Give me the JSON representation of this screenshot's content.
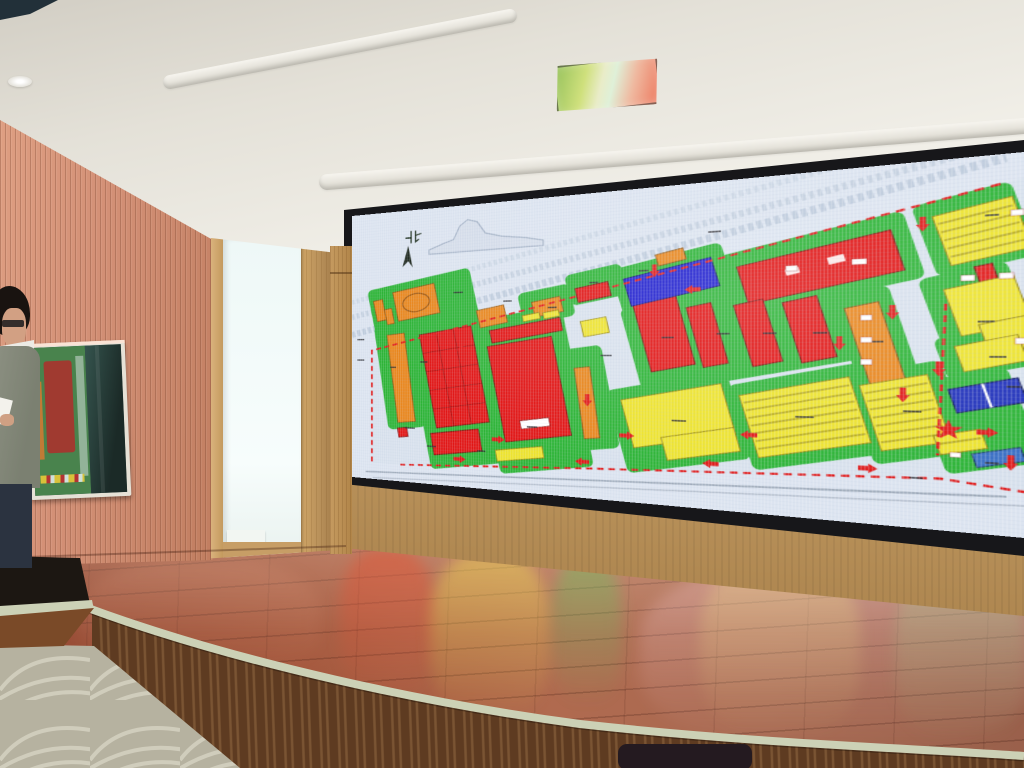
{
  "scene": {
    "setting": "presentation room with curved wooden stage and wall-size LED video wall",
    "colors": {
      "wall": "#d39076",
      "stage_floor": "#a3553a",
      "stage_trim": "#ccd1b6",
      "stage_fascia": "#5e3b21",
      "carpet": "#b6b2a0",
      "screen_bezel": "#17171a"
    }
  },
  "map": {
    "bg": "#dce4f0",
    "palette": {
      "green": "#2db437",
      "o": {
        "f": "#e8861d",
        "s": "#8a5210"
      },
      "r": {
        "f": "#e11616",
        "s": "#7d0b0b"
      },
      "y": {
        "f": "#ede32e",
        "s": "#94850e"
      },
      "b": {
        "f": "#2020cf",
        "s": "#10106a"
      },
      "b2": {
        "f": "#2233bb",
        "s": "#101a5a"
      },
      "b3": {
        "f": "#3a6fc4",
        "s": "#1c3a6a"
      }
    },
    "outside": {
      "lines": [
        {
          "d": "M0,150 L656,-10",
          "w": 8,
          "s": "#bfccdc",
          "dash": "4 3",
          "o": 0.8
        },
        {
          "d": "M0,128 L640,-30",
          "w": 7,
          "s": "#c5d1e0",
          "dash": "4 3",
          "o": 0.7
        },
        {
          "d": "M0,176 L660,4",
          "w": 9,
          "s": "#b8c6d8",
          "dash": "5 3",
          "o": 0.8
        },
        {
          "d": "M20,376 L660,346",
          "w": 2,
          "s": "#97a3b2",
          "o": 0.9
        },
        {
          "d": "M30,384 L672,354",
          "w": 1.5,
          "s": "#a8b2c0",
          "o": 0.8
        }
      ],
      "skyline": "M108,58 L128,50 L140,46 L148,28 L158,20 L170,24 L180,40 L200,46 L228,50 L249,55 L249,62 L108,64 Z"
    },
    "site": {
      "points": "29,199 656,30 672,26 672,342 613,332 69,362 29,362",
      "fill": "#d8e1ed"
    },
    "green": [
      [
        28,
        98,
        140,
        74,
        -11
      ],
      [
        42,
        160,
        52,
        150,
        -8
      ],
      [
        92,
        148,
        100,
        210,
        -10
      ],
      [
        180,
        148,
        108,
        208,
        -10
      ],
      [
        222,
        118,
        60,
        42,
        -11
      ],
      [
        276,
        96,
        62,
        40,
        -12
      ],
      [
        278,
        194,
        45,
        130,
        -9
      ],
      [
        328,
        84,
        112,
        58,
        -14
      ],
      [
        436,
        68,
        160,
        74,
        -14
      ],
      [
        342,
        124,
        200,
        108,
        -13
      ],
      [
        540,
        132,
        48,
        114,
        -14
      ],
      [
        328,
        234,
        122,
        104,
        -13
      ],
      [
        448,
        224,
        118,
        100,
        -14
      ],
      [
        550,
        216,
        76,
        98,
        -14
      ],
      [
        600,
        36,
        74,
        78,
        -15
      ],
      [
        608,
        114,
        66,
        102,
        -15
      ],
      [
        612,
        178,
        62,
        44,
        -15
      ],
      [
        604,
        222,
        70,
        98,
        -15
      ]
    ],
    "buildings": [
      [
        "o",
        62,
        110,
        57,
        42,
        -11,
        "ellipse"
      ],
      [
        "o",
        34,
        126,
        13,
        30,
        -11
      ],
      [
        "o",
        49,
        139,
        10,
        22,
        -11
      ],
      [
        "o",
        171,
        141,
        34,
        24,
        -12
      ],
      [
        "o",
        237,
        132,
        33,
        20,
        -12
      ],
      [
        "o",
        58,
        175,
        24,
        126,
        -7
      ],
      [
        "o",
        289,
        220,
        17,
        90,
        -7
      ],
      [
        "o",
        549,
        148,
        28,
        86,
        -14
      ],
      [
        "o",
        370,
        79,
        28,
        14,
        -14
      ],
      [
        "r",
        106,
        170,
        68,
        132,
        -10,
        "grid"
      ],
      [
        "r",
        112,
        310,
        62,
        30,
        -9
      ],
      [
        "r",
        186,
        164,
        84,
        17,
        -11
      ],
      [
        "r",
        193,
        186,
        77,
        129,
        -10,
        "label"
      ],
      [
        "r",
        286,
        116,
        36,
        18,
        -12
      ],
      [
        "r",
        450,
        85,
        133,
        45,
        -14,
        "windows"
      ],
      [
        "r",
        355,
        137,
        44,
        84,
        -13
      ],
      [
        "r",
        407,
        144,
        24,
        73,
        -13
      ],
      [
        "r",
        452,
        142,
        27,
        73,
        -14
      ],
      [
        "r",
        495,
        140,
        30,
        70,
        -14
      ],
      [
        "r",
        66,
        309,
        13,
        13,
        -8
      ],
      [
        "r",
        640,
        111,
        13,
        22,
        -14
      ],
      [
        "y",
        193,
        328,
        56,
        15,
        -9
      ],
      [
        "y",
        225,
        151,
        20,
        8,
        -11
      ],
      [
        "y",
        249,
        148,
        18,
        8,
        -11
      ],
      [
        "y",
        292,
        159,
        28,
        20,
        -11
      ],
      [
        "y",
        339,
        248,
        101,
        60,
        -13,
        "notch"
      ],
      [
        "y",
        456,
        238,
        97,
        73,
        -14,
        "stripes"
      ],
      [
        "y",
        559,
        229,
        54,
        72,
        -14,
        "stripes"
      ],
      [
        "y",
        613,
        50,
        59,
        54,
        -15,
        "stripes"
      ],
      [
        "y",
        621,
        128,
        51,
        50,
        -15,
        "step"
      ],
      [
        "y",
        626,
        188,
        46,
        27,
        -15
      ],
      [
        "y",
        610,
        283,
        35,
        20,
        -15,
        "stripes"
      ],
      [
        "b",
        339,
        99,
        89,
        35,
        -14
      ],
      [
        "b2",
        621,
        232,
        51,
        25,
        -15,
        "split"
      ],
      [
        "b3",
        637,
        300,
        35,
        14,
        -15
      ]
    ],
    "boundary": {
      "color": "#e01818",
      "paths": [
        "M656,30 L29,199 L29,362",
        "M69,362 L300,348 L613,332 L672,340",
        "M617,150 L611,308"
      ]
    },
    "arrows": [
      [
        150,
        190,
        90
      ],
      [
        150,
        258,
        90
      ],
      [
        188,
        318,
        0
      ],
      [
        247,
        166,
        0
      ],
      [
        298,
        254,
        90
      ],
      [
        332,
        304,
        0
      ],
      [
        413,
        126,
        180
      ],
      [
        368,
        94,
        90
      ],
      [
        465,
        296,
        180
      ],
      [
        535,
        183,
        90
      ],
      [
        566,
        88,
        90
      ],
      [
        577,
        150,
        90
      ],
      [
        585,
        238,
        90
      ],
      [
        639,
        282,
        0
      ],
      [
        663,
        304,
        90
      ],
      [
        140,
        348,
        0
      ],
      [
        300,
        340,
        180
      ],
      [
        430,
        332,
        180
      ],
      [
        550,
        326,
        0
      ],
      [
        612,
        210,
        90
      ],
      [
        600,
        58,
        90
      ]
    ],
    "marks_dark": [
      [
        75,
        308,
        14
      ],
      [
        96,
        214,
        10
      ],
      [
        230,
        298,
        12
      ],
      [
        312,
        204,
        12
      ],
      [
        140,
        118,
        12
      ],
      [
        202,
        132,
        10
      ],
      [
        254,
        142,
        10
      ],
      [
        375,
        182,
        12
      ],
      [
        428,
        178,
        12
      ],
      [
        470,
        178,
        12
      ],
      [
        513,
        178,
        12
      ],
      [
        560,
        188,
        10
      ],
      [
        300,
        112,
        10
      ],
      [
        420,
        58,
        12
      ],
      [
        385,
        282,
        14
      ],
      [
        498,
        272,
        16
      ],
      [
        585,
        262,
        14
      ],
      [
        640,
        168,
        12
      ],
      [
        648,
        204,
        12
      ],
      [
        352,
        100,
        10
      ],
      [
        645,
        60,
        10
      ],
      [
        660,
        234,
        10
      ],
      [
        645,
        312,
        10
      ],
      [
        590,
        332,
        10
      ],
      [
        170,
        334,
        10
      ],
      [
        105,
        332,
        12
      ],
      [
        55,
        222,
        8
      ],
      [
        8,
        212,
        10
      ],
      [
        8,
        182,
        10
      ]
    ],
    "marks_white": [
      [
        490,
        103,
        10,
        6
      ],
      [
        545,
        99,
        12,
        6
      ],
      [
        663,
        57,
        9,
        6
      ],
      [
        628,
        121,
        10,
        6
      ],
      [
        655,
        120,
        10,
        6
      ],
      [
        552,
        160,
        9,
        6
      ],
      [
        552,
        184,
        9,
        6
      ],
      [
        552,
        208,
        9,
        6
      ],
      [
        666,
        186,
        9,
        6
      ],
      [
        620,
        304,
        8,
        5
      ]
    ],
    "star": {
      "points": "619,270 621.6,277.4 629.5,277.6 623.2,282.4 625.5,289.9 619,285.4 612.5,289.9 614.8,282.4 608.5,277.6 616.4,277.4",
      "color": "#e01818"
    },
    "compass": {
      "label": "北",
      "glyph_paths": [
        "M84,30 L84,46",
        "M77,39 L84,39",
        "M90,30 L90,45 L94,42",
        "M90,36 L97,34"
      ],
      "arrow_points": "80,50 72,80 80,72 86,81"
    }
  }
}
